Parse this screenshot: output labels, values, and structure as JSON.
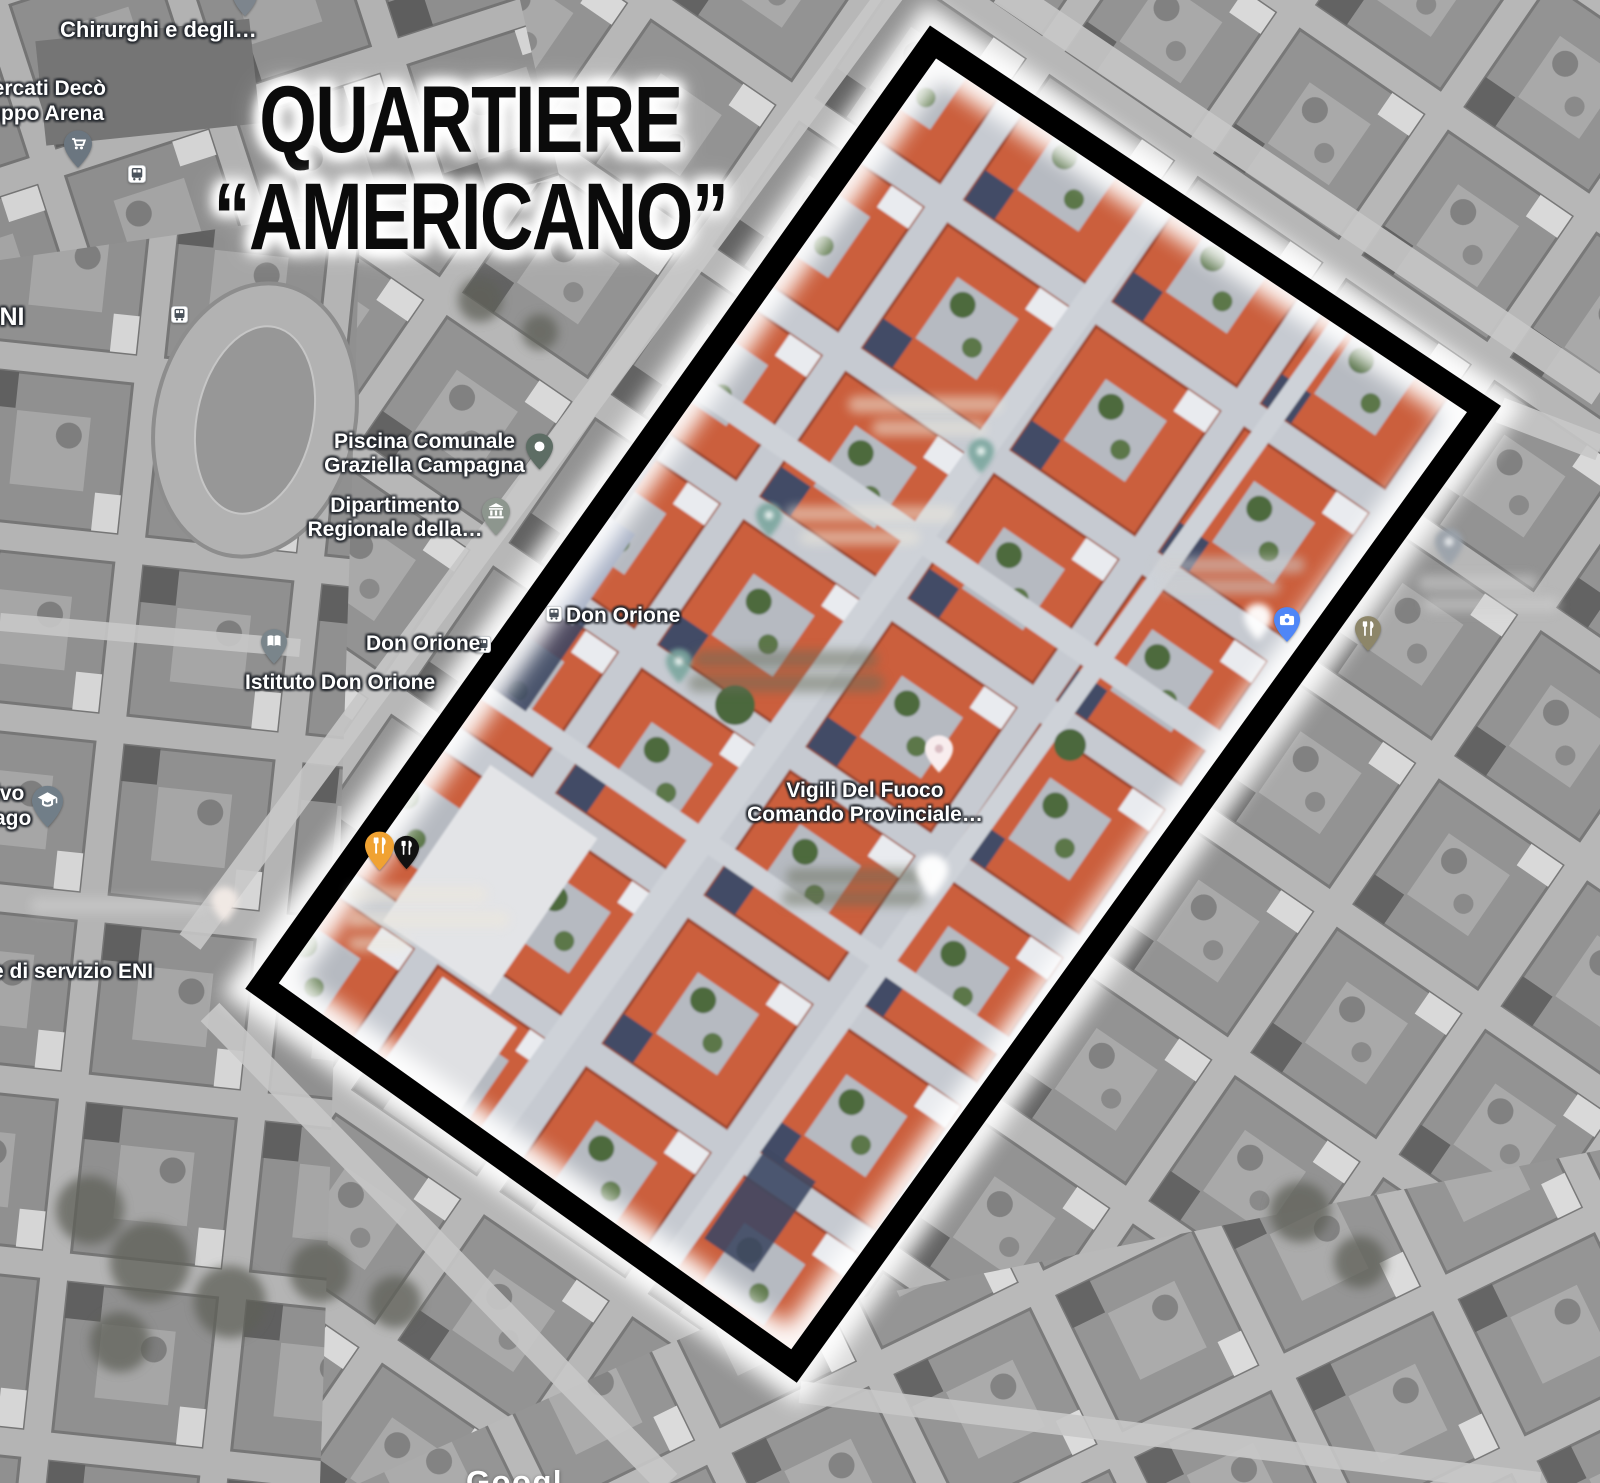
{
  "title": {
    "line1": "QUARTIERE",
    "line2": "“AMERICANO”"
  },
  "watermark": "Googl",
  "labels": {
    "surgeons": "Chirurghi e degli…",
    "supermarket_line1": "mercati Decò",
    "supermarket_line2": "ruppo Arena",
    "left_edge_oni": "ONI",
    "pool_line1": "Piscina Comunale",
    "pool_line2": "Graziella Campagna",
    "department_line1": "Dipartimento",
    "department_line2": "Regionale della…",
    "don_orione_area": "Don Orione",
    "don_orione_stop": "Don Orione",
    "istituto_don_orione": "Istituto Don Orione",
    "left_edge_ivo": "ivo",
    "left_edge_ago": "ago",
    "eni_station": "e di servizio ENI",
    "fire_line1": "Vigili Del Fuoco",
    "fire_line2": "Comando Provinciale…"
  },
  "colors": {
    "highlight_border": "#000000",
    "border_glow": "#ffffff",
    "roof_orange": "#cb5e3c",
    "restaurant_pin_orange": "#f0a232",
    "restaurant_pin_black": "#111111",
    "restaurant_pin_khaki": "#8d8669",
    "photo_pin_blue": "#4f86f7",
    "pool_pin_green": "#5d6d64",
    "label_text": "#ffffff"
  }
}
